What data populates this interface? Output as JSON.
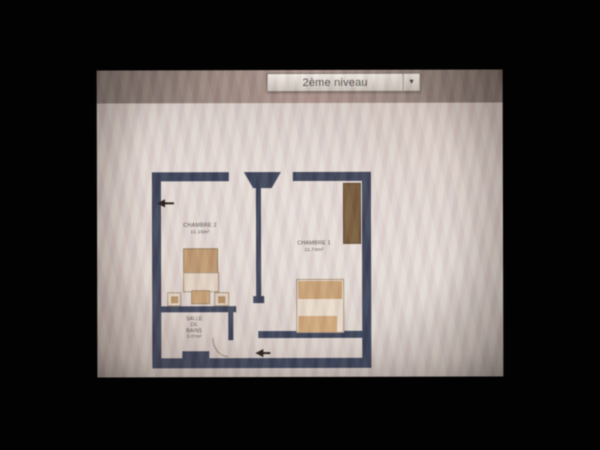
{
  "toolbar": {
    "level_selector": {
      "value": "2ème niveau",
      "arrow_icon": "▼"
    }
  },
  "floor_plan": {
    "rooms": {
      "chambre2": {
        "name": "CHAMBRE 2",
        "area": "11.15m²"
      },
      "chambre1": {
        "name": "CHAMBRE 1",
        "area": "11.74m²"
      },
      "bathroom": {
        "lines": [
          "SALLE",
          "DE",
          "BAINS"
        ],
        "area": "3.07m²"
      }
    },
    "colors": {
      "wall": "#2d3950",
      "bed_tan": "#c49e72",
      "bed_light": "#e9ddcc",
      "wardrobe_brown": "#6d5330",
      "screen_tint": "#d9d0ca"
    }
  }
}
